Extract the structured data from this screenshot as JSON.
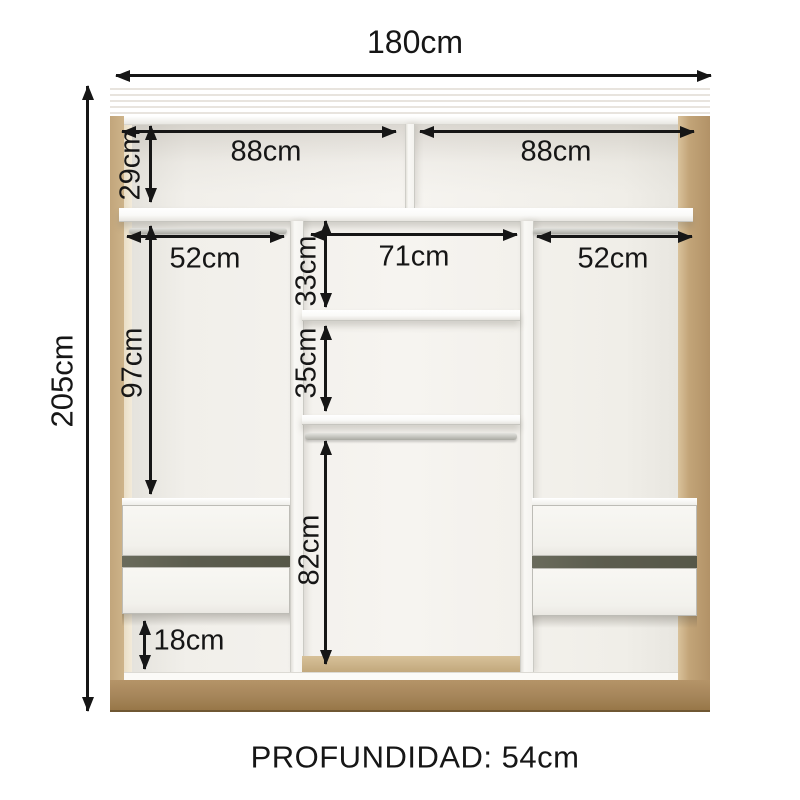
{
  "footer_label": "PROFUNDIDAD: 54cm",
  "dims": {
    "total_width": "180cm",
    "total_height": "205cm",
    "top_left_width": "88cm",
    "top_right_width": "88cm",
    "top_section_height": "29cm",
    "left_rod_width": "52cm",
    "right_rod_width": "52cm",
    "center_width": "71cm",
    "center_upper_height": "33cm",
    "center_middle_height": "35cm",
    "center_lower_height": "82cm",
    "left_hanging_height": "97cm",
    "plinth_gap_height": "18cm"
  },
  "colors": {
    "wood_top": "#BA9C6E",
    "wood_side": "#C7AC82",
    "wood_base": "#A5855A",
    "interior_back": "#F1EFEA",
    "panel_white": "#F9F8F5",
    "drawer_gap": "#5C5D4F",
    "dimension_line": "#161616"
  }
}
